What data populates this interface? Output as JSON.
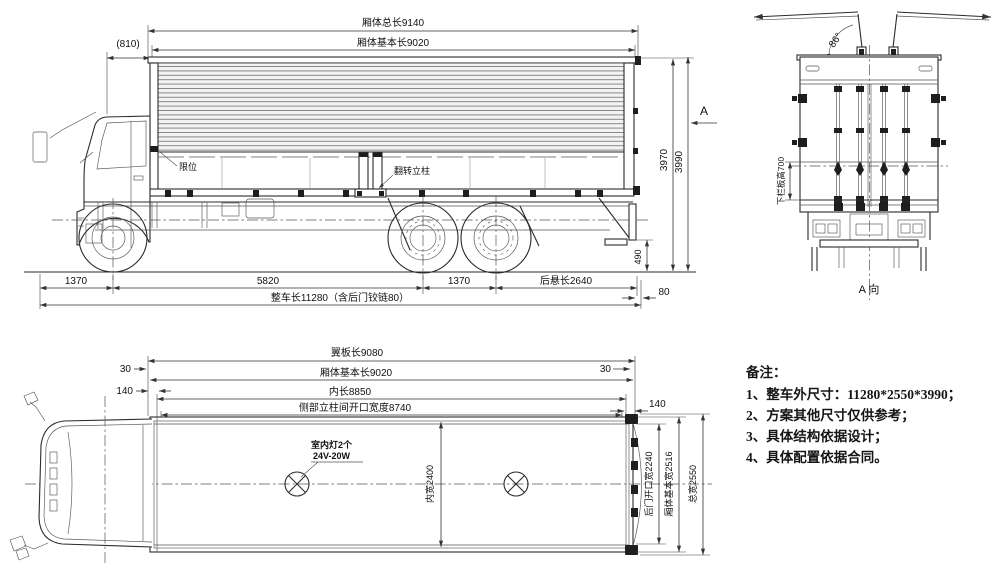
{
  "side_view": {
    "labels": {
      "box_total_length": "厢体总长9140",
      "box_basic_length": "厢体基本长9020",
      "cab_gap": "(810)",
      "limit_stop": "限位",
      "flip_pillar": "翻转立柱",
      "height_3970": "3970",
      "height_3990": "3990",
      "section_a": "A",
      "dim_490": "490",
      "front_overhang": "1370",
      "wheelbase": "5820",
      "tandem_spacing": "1370",
      "rear_overhang": "后悬长2640",
      "overall_length": "整车长11280（含后门铰链80）",
      "hinge_80": "80"
    }
  },
  "rear_view": {
    "labels": {
      "wing_open_angle": "86°",
      "lower_panel_height": "下栏板高700",
      "view_direction": "A 向"
    }
  },
  "top_view": {
    "labels": {
      "wing_plate_length": "翼板长9080",
      "box_basic_length": "厢体基本长9020",
      "inner_length": "内长8850",
      "pillar_opening_width": "侧部立柱间开口宽度8740",
      "left_30": "30",
      "left_140": "140",
      "right_30": "30",
      "right_140": "140",
      "lamp_line1": "室内灯2个",
      "lamp_line2": "24V-20W",
      "inner_width": "内宽2400",
      "rear_door_opening_width": "后门开口宽2240",
      "box_basic_width": "厢体基本宽2516",
      "overall_width": "总宽2550"
    }
  },
  "notes": {
    "title": "备注：",
    "items": [
      "1、整车外尺寸：11280*2550*3990；",
      "2、方案其他尺寸仅供参考；",
      "3、具体结构依据设计；",
      "4、具体配置依据合同。"
    ]
  },
  "colors": {
    "line": "#2b2b2b",
    "background": "#ffffff"
  }
}
